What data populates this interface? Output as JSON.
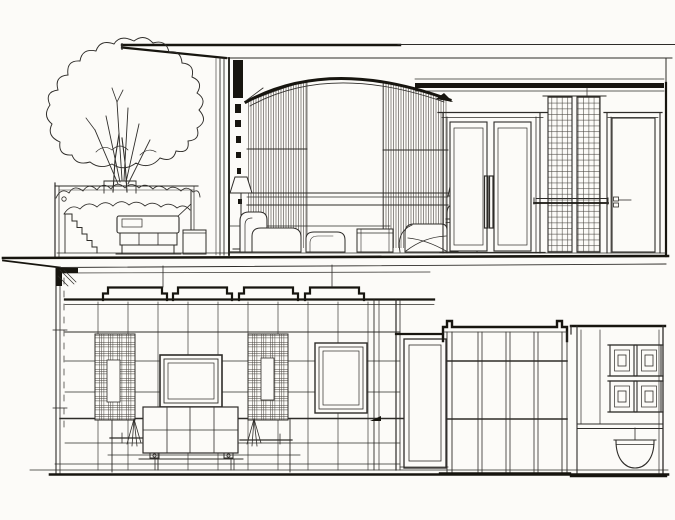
{
  "meta": {
    "title": "Two-level interior elevation section, ink sketch",
    "medium": "architectural line drawing, no text labels"
  },
  "canvas": {
    "width": 675,
    "height": 520,
    "paper_color": "#fcfbf8",
    "ink_color": "#2e2c29",
    "ink_heavy": "#17150f",
    "ink_hatch": "#45423c"
  },
  "scene": {
    "upper_level": {
      "elements": [
        "roof-canopy-eave",
        "barrel-vault-arch",
        "section-column",
        "curtain-wall-left",
        "curtain-wall-right",
        "window-transom",
        "terrace-pergola-planter",
        "shrub-hedge",
        "tree",
        "stair",
        "sofa",
        "side-table",
        "floor-lamp",
        "chaise-lounge",
        "ottoman",
        "cube-table",
        "armchair",
        "table-lamp",
        "lamp-table",
        "double-door",
        "door-pull-handles",
        "lattice-screen-pair",
        "shelf-rail",
        "single-door",
        "door-lock-detail",
        "ceiling-beam-band",
        "floor-slab"
      ]
    },
    "lower_level": {
      "elements": [
        "cantilevered-slab-edge",
        "left-wall-downpipe",
        "coffered-ceiling-four-coffers",
        "wall-grid",
        "plaid-panel-left",
        "plaid-panel-right",
        "panel-niche-left",
        "panel-niche-right",
        "sconce-left",
        "sconce-right",
        "media-screen-frame",
        "console-cabinet",
        "framed-window",
        "door-bay",
        "single-door",
        "glazed-partition-notched-band",
        "partition-rails",
        "vanity-cabinet",
        "square-door-panels",
        "washbasin",
        "floor-line"
      ]
    }
  }
}
